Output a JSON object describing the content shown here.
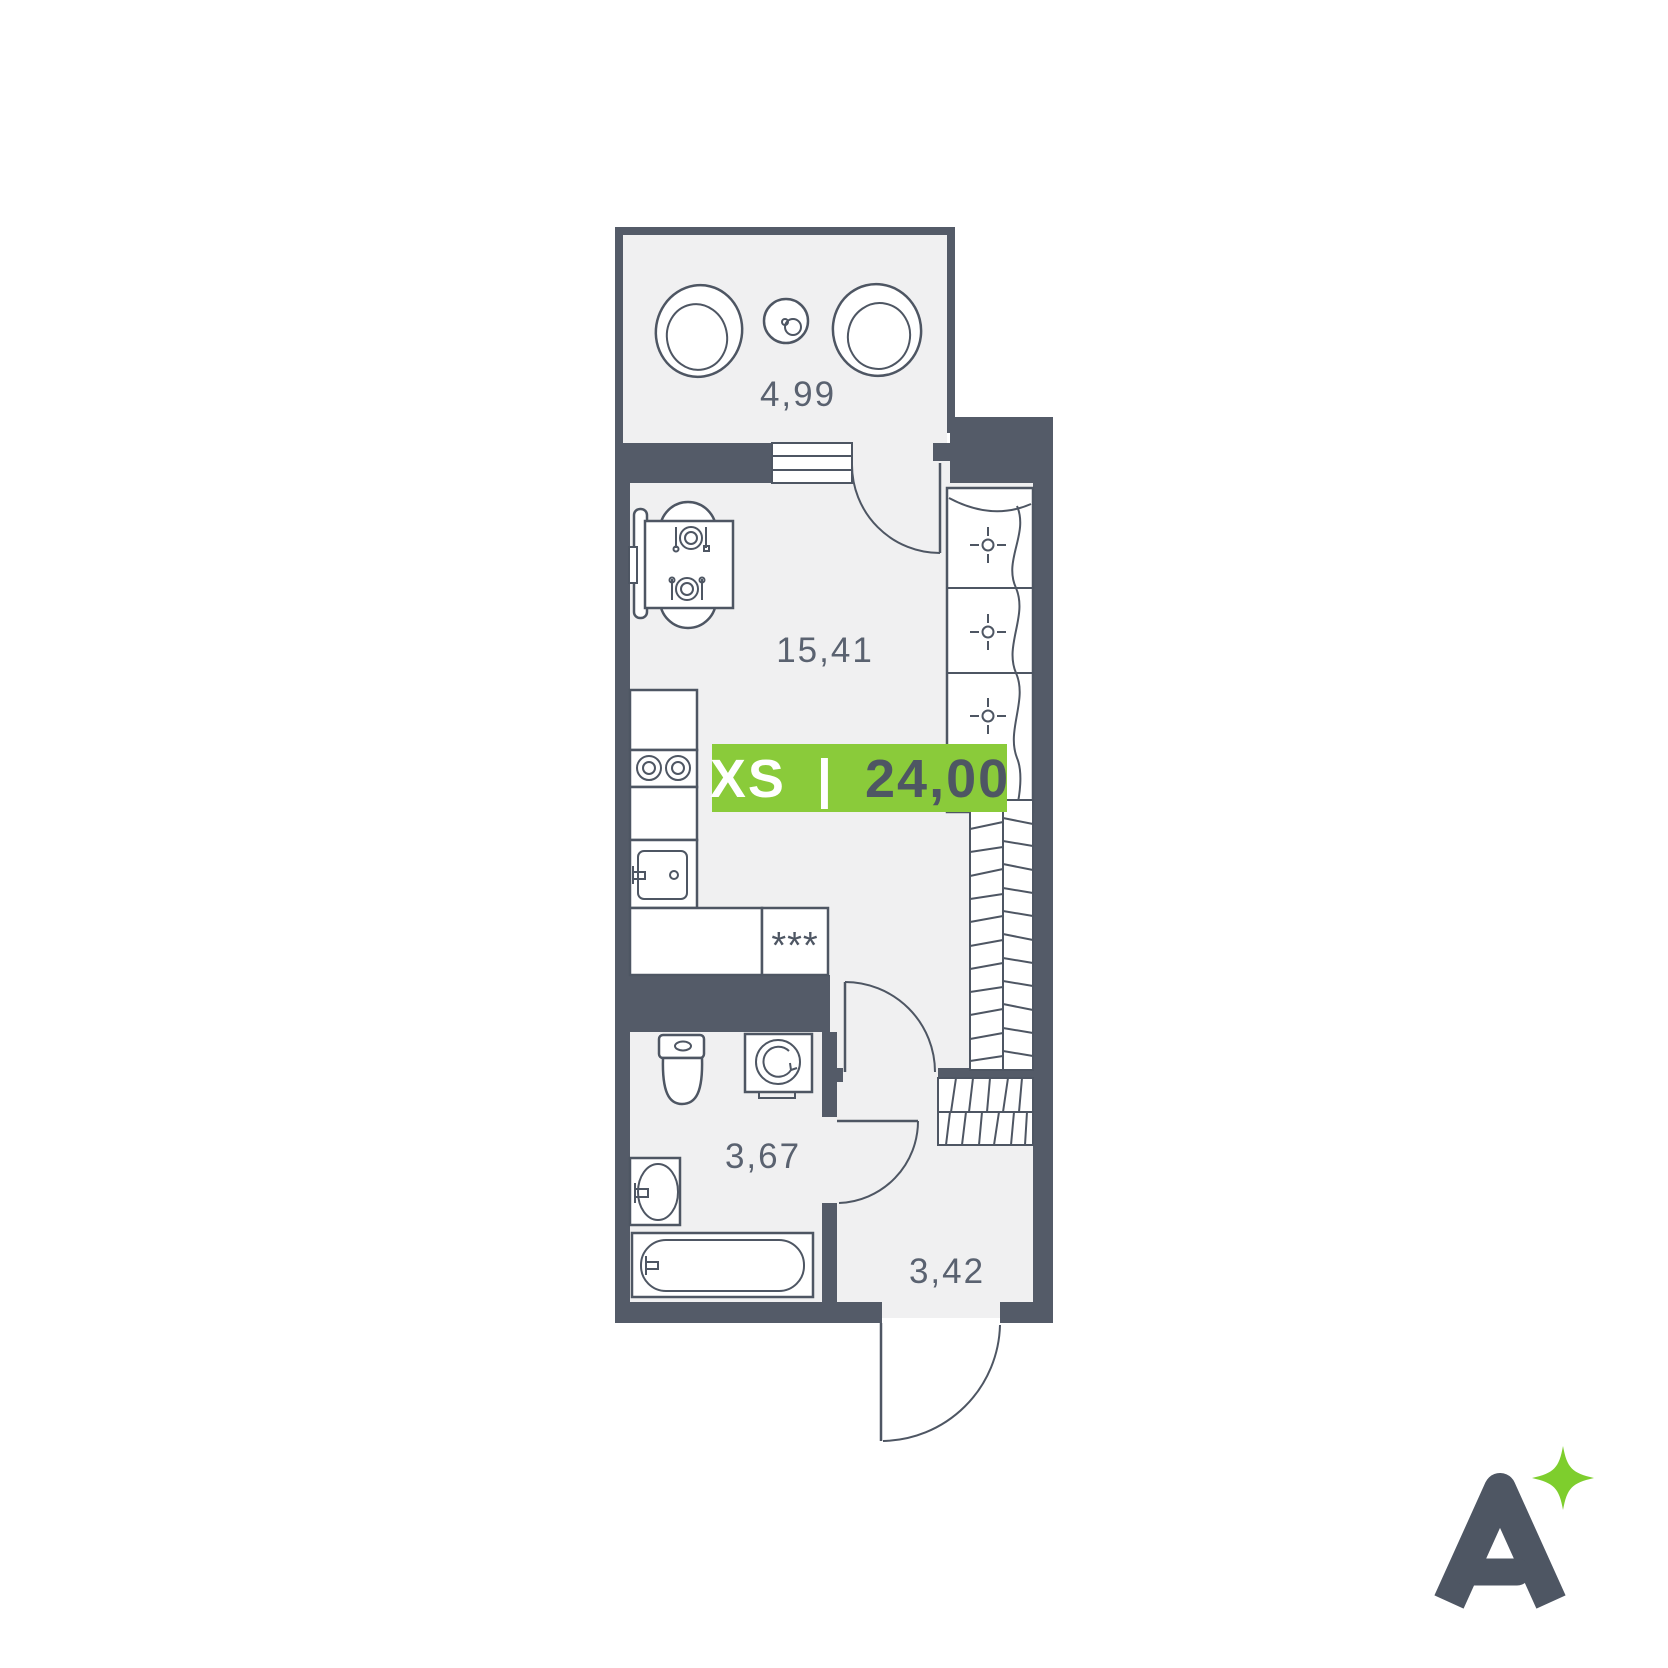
{
  "floor_plan": {
    "rooms": [
      {
        "id": "balcony",
        "area_label": "4,99"
      },
      {
        "id": "living-room",
        "area_label": "15,41"
      },
      {
        "id": "bathroom",
        "area_label": "3,67"
      },
      {
        "id": "hallway",
        "area_label": "3,42"
      }
    ],
    "counter_marker": "***",
    "badge": {
      "size_class": "XS",
      "separator": "|",
      "total_area": "24,00"
    },
    "icons": [
      "lounge-chair-icon",
      "coffee-table-icon",
      "dining-table-icon",
      "place-setting-icon",
      "stove-burner-icon",
      "sink-icon",
      "wardrobe-hanger-icon",
      "stairs-hatch-icon",
      "toilet-icon",
      "washing-machine-icon",
      "bathtub-icon",
      "door-swing-icon",
      "window-icon"
    ]
  },
  "logo": {
    "letter": "A",
    "sparkle": "four-point-star"
  },
  "colors": {
    "wall": "#545B68",
    "line": "#4E5663",
    "floor": "#F0F0F1",
    "label": "#5A6270",
    "accent": "#8ACB3A",
    "star": "#7ECE2D",
    "white": "#FFFFFF"
  }
}
